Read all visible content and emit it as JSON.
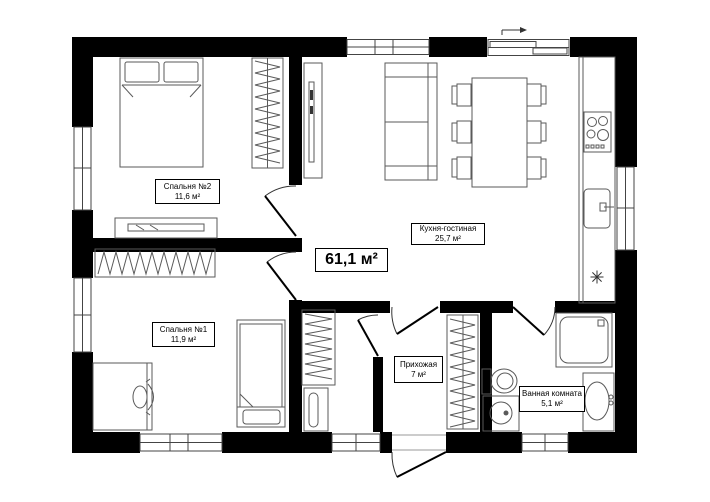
{
  "plan": {
    "title": "Floor plan 61,1 m2 apartment",
    "total_area": "61,1 м²",
    "rooms": {
      "bedroom2": {
        "name": "Спальня №2",
        "area": "11,6 м²"
      },
      "bedroom1": {
        "name": "Спальня №1",
        "area": "11,9 м²"
      },
      "kitchen_living": {
        "name": "Кухня-гостиная",
        "area": "25,7 м²"
      },
      "hallway": {
        "name": "Прихожая",
        "area": "7 м²"
      },
      "bathroom": {
        "name": "Ванная комната",
        "area": "5,1 м²"
      }
    },
    "symbols": {
      "kitchen_marker": "✳",
      "slide_direction_arrow": "→"
    },
    "colors": {
      "wall": "#000000",
      "furniture_line": "#5a5a5a",
      "background": "#ffffff"
    }
  }
}
